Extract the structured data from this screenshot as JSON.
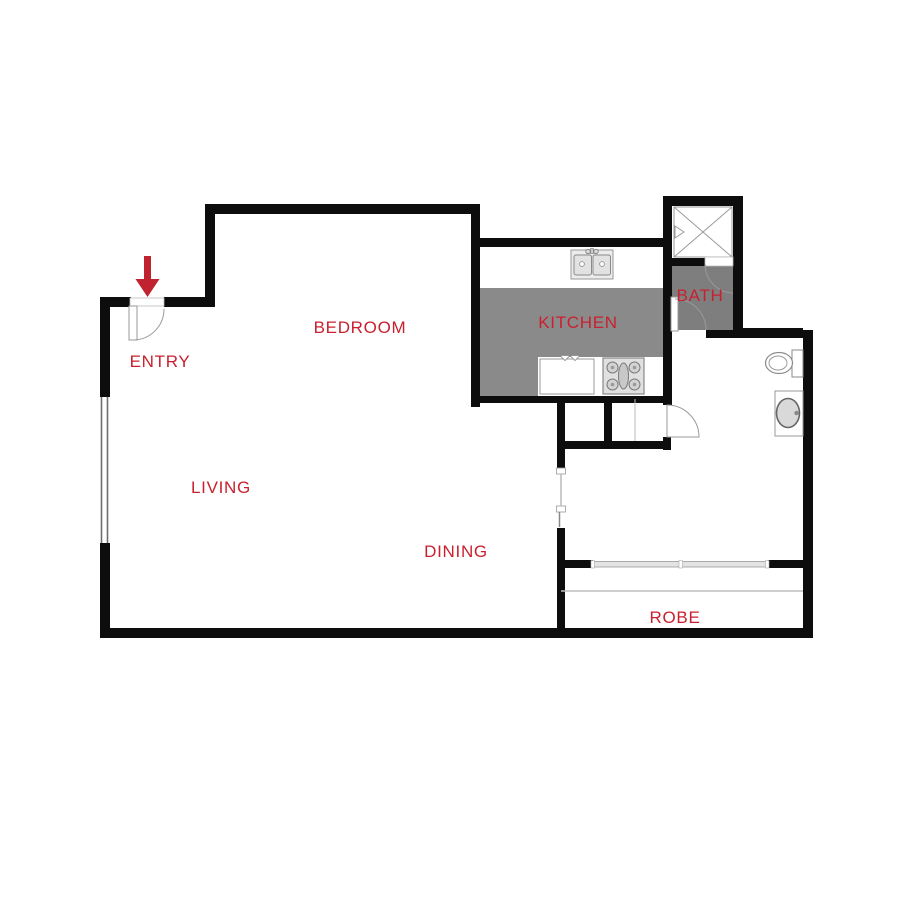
{
  "plan": {
    "title": "Studio apartment floor plan",
    "rooms": {
      "entry": "ENTRY",
      "bedroom": "BEDROOM",
      "kitchen": "KITCHEN",
      "bath": "BATH",
      "living": "LIVING",
      "dining": "DINING",
      "robe": "ROBE"
    },
    "colors": {
      "wall": "#0d0d0d",
      "label": "#c9202f",
      "arrow": "#c02230",
      "kitchen_floor": "#8a8a8a",
      "bath_floor": "#7e7e7e",
      "fixture_outline": "#999999",
      "slider_fill": "#e3e3e3",
      "shelf_line": "#bdbdbd"
    },
    "icons": [
      "entry-arrow-icon",
      "entry-door-icon",
      "window-icon",
      "double-sink-icon",
      "stove-icon",
      "cabinet-icon",
      "shower-icon",
      "toilet-icon",
      "vanity-basin-icon",
      "door-swing-icon",
      "sliding-door-icon",
      "cavity-slider-icon"
    ]
  }
}
